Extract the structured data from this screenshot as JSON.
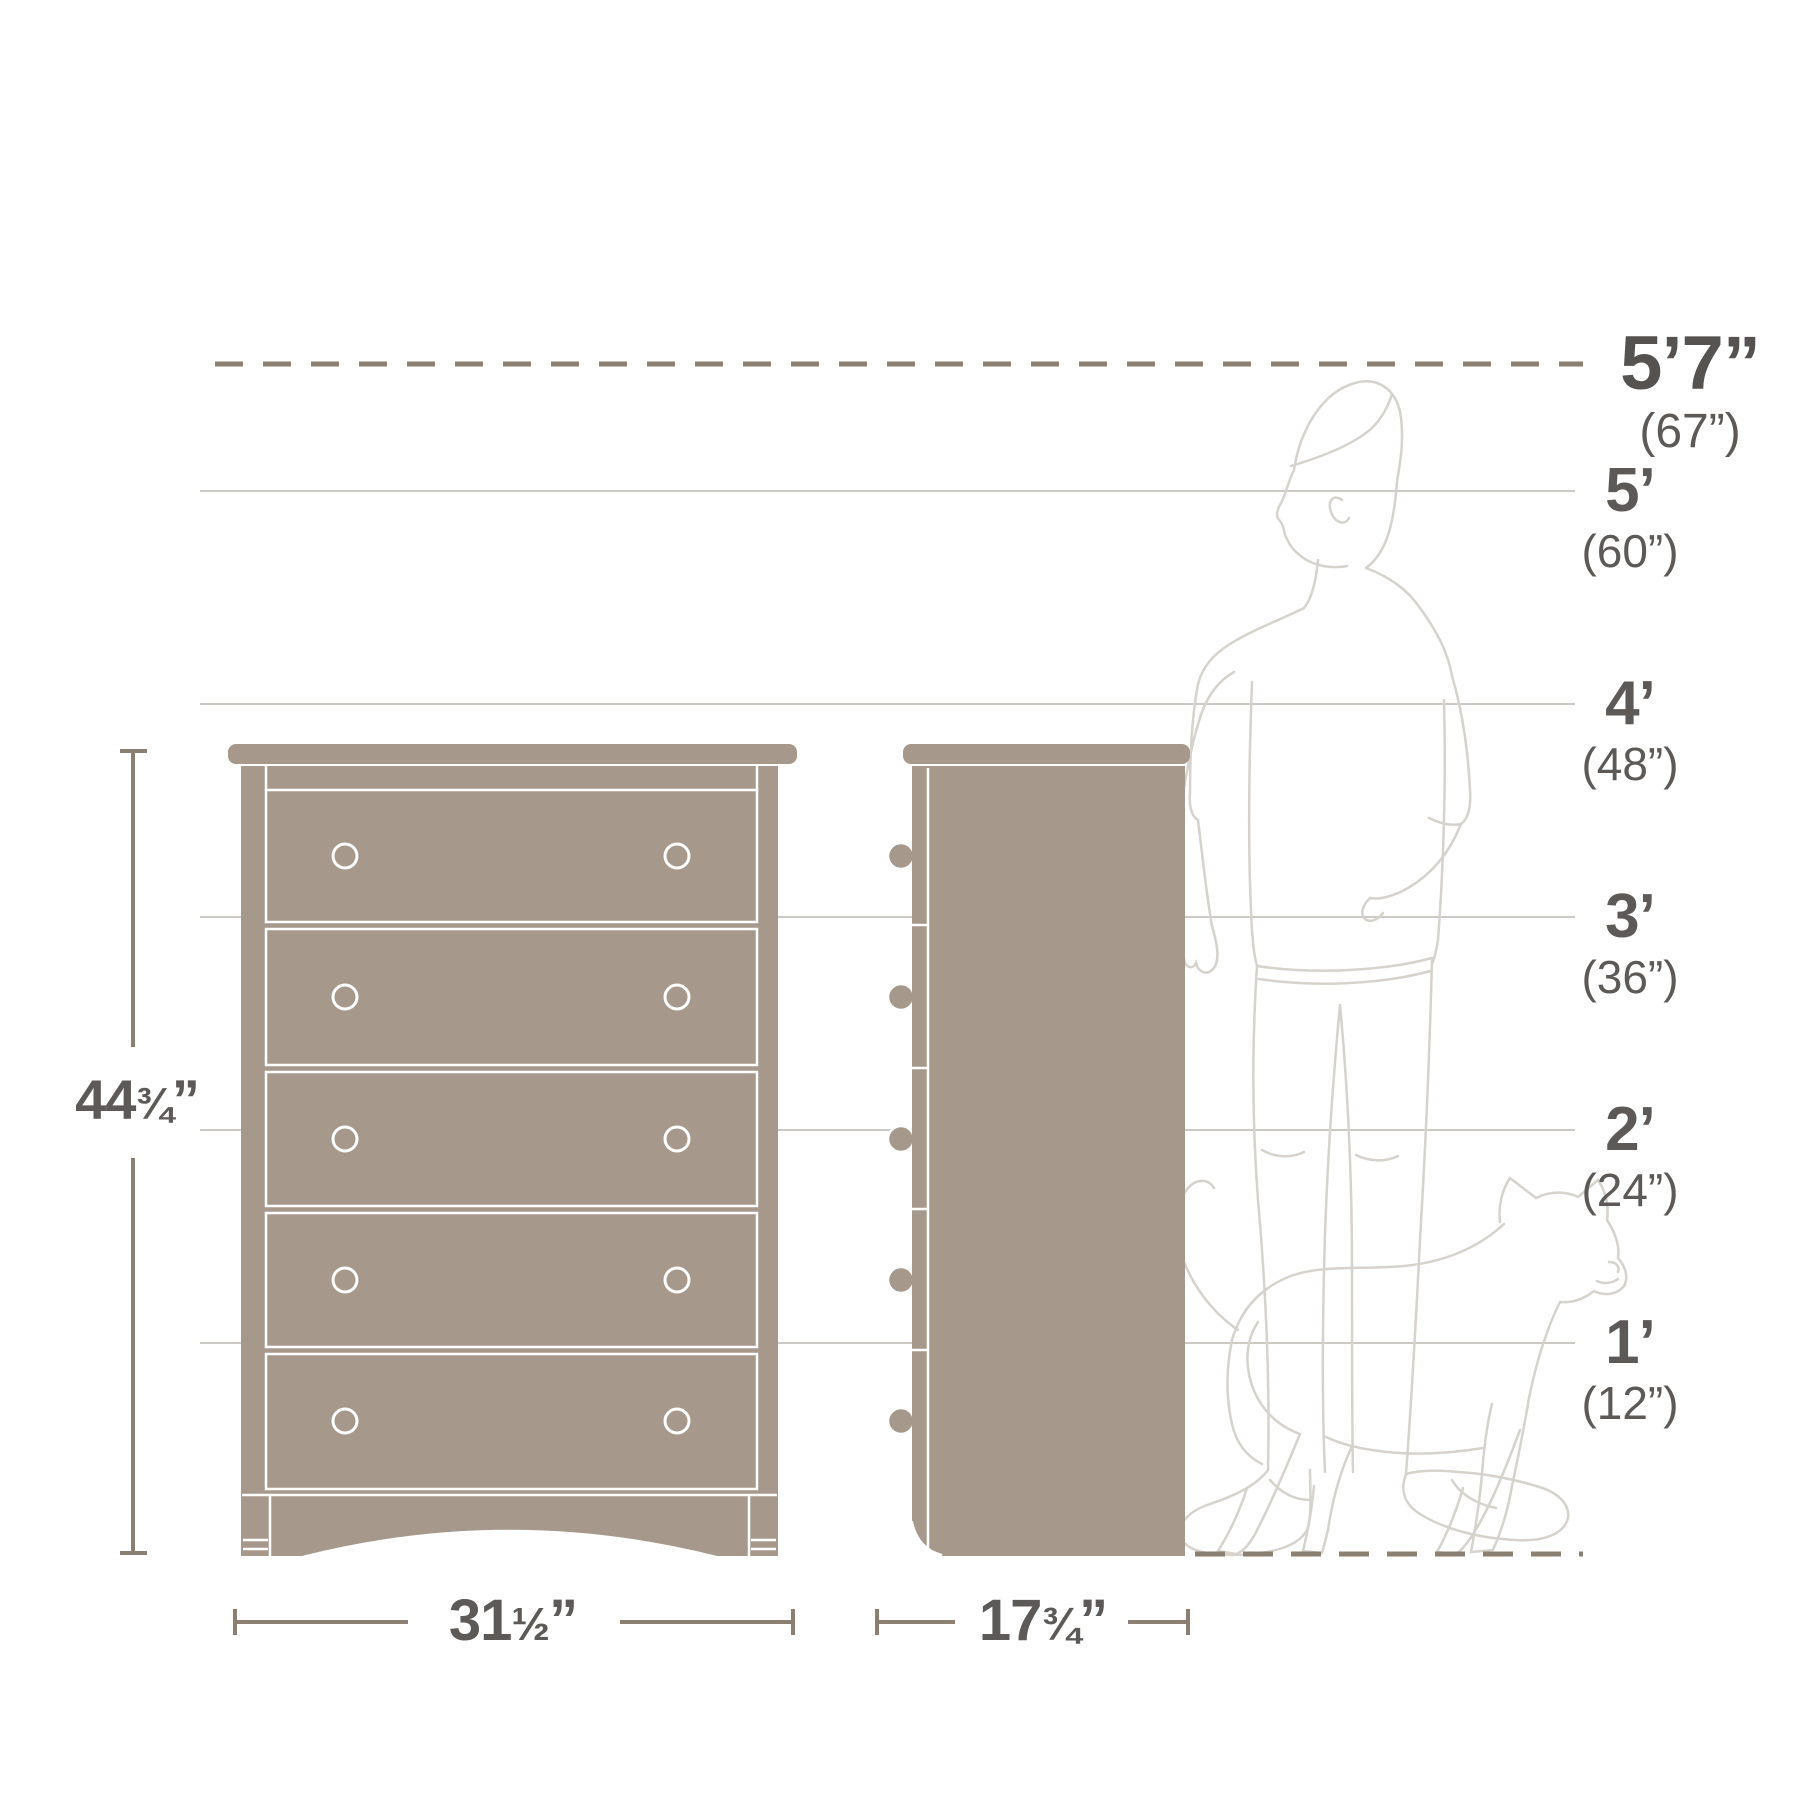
{
  "colors": {
    "furniture_fill": "#a6998b",
    "dimension_line": "#8b7f71",
    "grid_line": "#cdc9c4",
    "text": "#5c5956",
    "silhouette_line": "#d6d2cc",
    "outline": "#ffffff"
  },
  "height_markers": [
    {
      "label": "5’7”",
      "sub": "(67”)"
    },
    {
      "label": "5’",
      "sub": "(60”)"
    },
    {
      "label": "4’",
      "sub": "(48”)"
    },
    {
      "label": "3’",
      "sub": "(36”)"
    },
    {
      "label": "2’",
      "sub": "(24”)"
    },
    {
      "label": "1’",
      "sub": "(12”)"
    }
  ],
  "dimensions": {
    "height": {
      "main": "44",
      "frac": "¾",
      "unit": "”"
    },
    "width": {
      "main": "31",
      "frac": "½",
      "unit": "”"
    },
    "depth": {
      "main": "17",
      "frac": "¾",
      "unit": "”"
    }
  },
  "illustrations": {
    "front_view": "chest-front-view",
    "side_view": "chest-side-view",
    "person": "person-silhouette",
    "cat": "cat-silhouette"
  }
}
